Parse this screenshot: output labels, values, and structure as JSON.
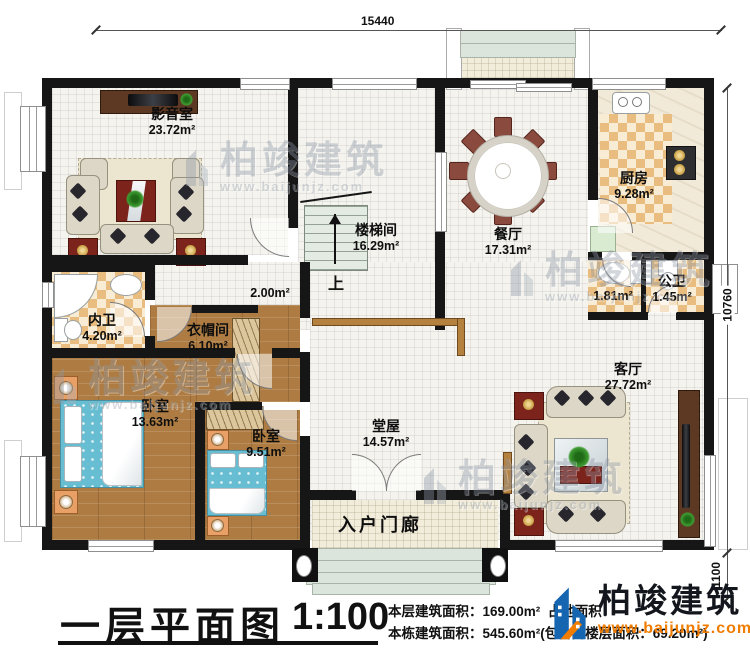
{
  "dimensions": {
    "top": "15440",
    "right": "10760",
    "bottom_right": "1100"
  },
  "rooms": [
    {
      "id": "media-room",
      "name": "影音室",
      "area": "23.72m²"
    },
    {
      "id": "stairwell",
      "name": "楼梯间",
      "area": "16.29m²"
    },
    {
      "id": "dining-room",
      "name": "餐厅",
      "area": "17.31m²"
    },
    {
      "id": "kitchen",
      "name": "厨房",
      "area": "9.28m²"
    },
    {
      "id": "wash-area",
      "name": "",
      "area": "1.81m²"
    },
    {
      "id": "public-bath",
      "name": "公卫",
      "area": "1.45m²"
    },
    {
      "id": "small-hall",
      "name": "",
      "area": "2.00m²"
    },
    {
      "id": "private-bath",
      "name": "内卫",
      "area": "4.20m²"
    },
    {
      "id": "cloakroom",
      "name": "衣帽间",
      "area": "6.10m²"
    },
    {
      "id": "bedroom-1",
      "name": "卧室",
      "area": "13.63m²"
    },
    {
      "id": "bedroom-2",
      "name": "卧室",
      "area": "9.51m²"
    },
    {
      "id": "main-hall",
      "name": "堂屋",
      "area": "14.57m²"
    },
    {
      "id": "living-room",
      "name": "客厅",
      "area": "27.72m²"
    },
    {
      "id": "entry-porch",
      "name": "入户门廊",
      "area": ""
    }
  ],
  "stairs": {
    "up_label": "上"
  },
  "title_block": {
    "title": "一层平面图",
    "scale": "1:100",
    "line1_a": "本层建筑面积：169.00m²",
    "line1_b": "占地面积：",
    "line2": "本栋建筑面积：545.60m²(包含阁楼层面积：69.20m²)"
  },
  "brand": {
    "name": "柏竣建筑",
    "site": "www.baijunjz.com"
  },
  "watermark": {
    "name": "柏竣建筑",
    "site": "www.baijunjz.com"
  },
  "colors": {
    "wall": "#161616",
    "wood_floor": "#ae7c42",
    "checker_tile": "#e9bd80",
    "bed_blue": "#67bdd1",
    "accent_red": "#7c241c",
    "brand_blue": "#1565b0",
    "brand_orange": "#f07c00"
  }
}
